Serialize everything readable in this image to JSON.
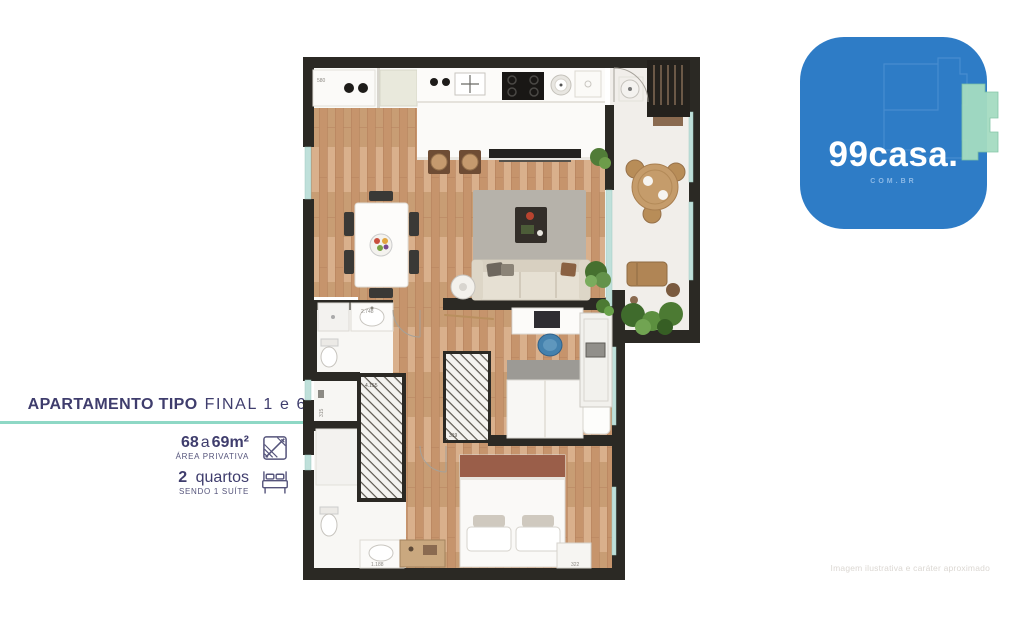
{
  "info": {
    "title": {
      "bold": "APARTAMENTO TIPO",
      "regular": "FINAL 1 e 6"
    },
    "area": {
      "num1": "68",
      "conj": "a",
      "num2": "69m²",
      "sublabel": "ÁREA PRIVATIVA"
    },
    "bedrooms": {
      "num": "2",
      "word": "quartos",
      "sublabel": "SENDO 1 SUÍTE"
    },
    "accent_line_color": "#8ed8c5",
    "text_color": "#3f3d6d"
  },
  "logo": {
    "brand": "99casa.",
    "domain": "COM.BR",
    "bg_color": "#2e7cc6",
    "accent_green": "#a5dcc1"
  },
  "watermark": "Imagem ilustrativa e caráter aproximado",
  "floor_plan": {
    "dimension_labels": [
      {
        "text": "580"
      },
      {
        "text": "2.748"
      },
      {
        "text": "315"
      },
      {
        "text": "4.155"
      },
      {
        "text": "319"
      },
      {
        "text": "1.188"
      },
      {
        "text": "322"
      }
    ],
    "colors": {
      "wall": "#2b2924",
      "wood_floor": "#cfa37e",
      "balcony_floor": "#f1eeea",
      "glass": "#bfe0da",
      "rug": "#b6b2aa",
      "sofa": "#e6e0d3",
      "plants": "#517c38"
    }
  }
}
